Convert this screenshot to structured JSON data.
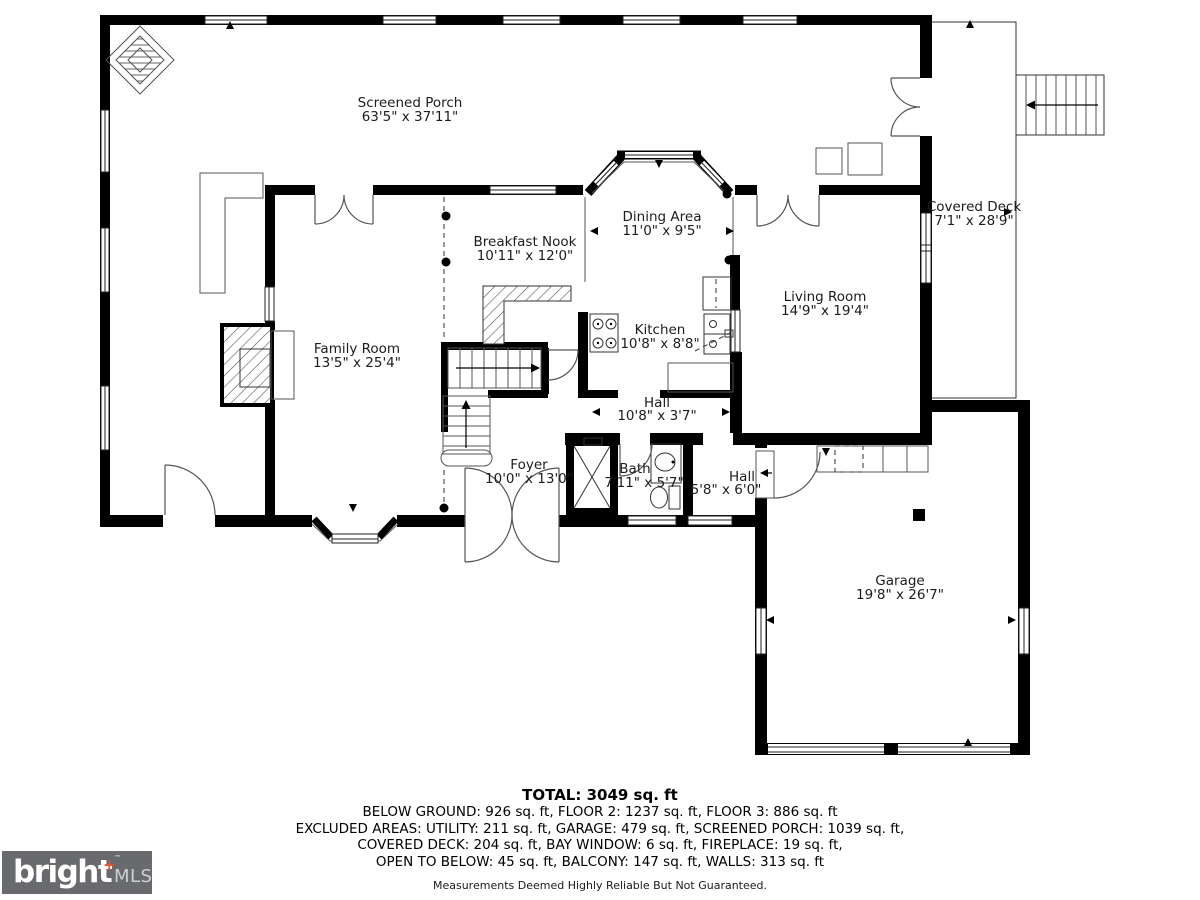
{
  "floor_plan": {
    "rooms": [
      {
        "name": "Screened Porch",
        "dims": "63'5\" x 37'11\""
      },
      {
        "name": "Covered Deck",
        "dims": "7'1\" x 28'9\""
      },
      {
        "name": "Dining Area",
        "dims": "11'0\" x 9'5\""
      },
      {
        "name": "Breakfast Nook",
        "dims": "10'11\" x 12'0\""
      },
      {
        "name": "Living Room",
        "dims": "14'9\" x 19'4\""
      },
      {
        "name": "Family Room",
        "dims": "13'5\" x 25'4\""
      },
      {
        "name": "Kitchen",
        "dims": "10'8\" x 8'8\""
      },
      {
        "name": "Hall",
        "dims": "10'8\" x 3'7\""
      },
      {
        "name": "Foyer",
        "dims": "10'0\" x 13'0\""
      },
      {
        "name": "Bath",
        "dims": "7'11\" x 5'7\""
      },
      {
        "name": "Hall",
        "dims": "5'8\" x 6'0\""
      },
      {
        "name": "Garage",
        "dims": "19'8\" x 26'7\""
      }
    ]
  },
  "summary": {
    "total": "TOTAL: 3049 sq. ft",
    "line1": "BELOW GROUND: 926 sq. ft, FLOOR 2: 1237 sq. ft, FLOOR 3: 886 sq. ft",
    "line2": "EXCLUDED AREAS: UTILITY: 211 sq. ft, GARAGE: 479 sq. ft, SCREENED PORCH: 1039 sq. ft,",
    "line3": "COVERED DECK: 204 sq. ft, BAY WINDOW: 6 sq. ft, FIREPLACE: 19 sq. ft,",
    "line4": "OPEN TO BELOW: 45 sq. ft, BALCONY: 147 sq. ft, WALLS: 313 sq. ft",
    "disclaimer": "Measurements Deemed Highly Reliable But Not Guaranteed."
  },
  "logo": {
    "brand": "bright",
    "plus": "+",
    "tm": "™",
    "suffix": "MLS",
    "bg_color": "#696a6d",
    "plus_color": "#e2552d"
  }
}
